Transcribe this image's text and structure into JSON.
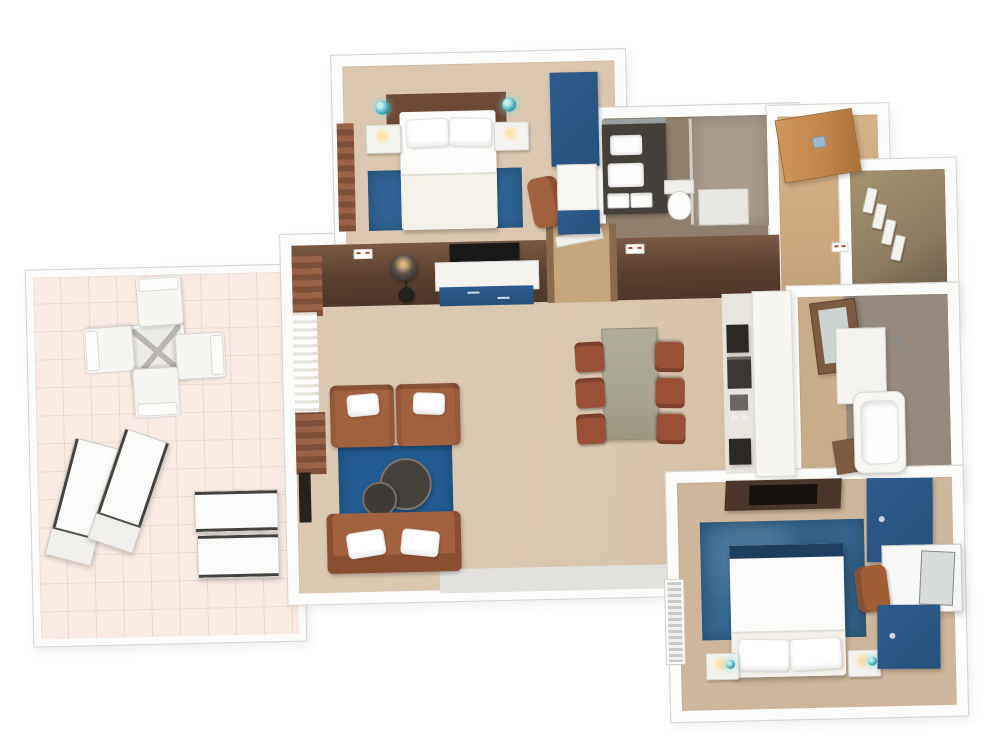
{
  "meta": {
    "title": "3D floor plan — two-bedroom suite with balcony terrace",
    "style": "top-down 3D architectural render on white background",
    "background": "#ffffff"
  },
  "colors": {
    "wall": "#fcfcfb",
    "wallEdge": "#d8d6d2",
    "shadowBand": "#e3e1de",
    "floorWood": "#d9c6ae",
    "floorBedroom1": "#dbc7af",
    "floorBedroom2": "#cdb69b",
    "floorBalcony": "#f9ebe2",
    "floorBath1": "#8f7f6c",
    "floorShower": "#a89b8a",
    "floorCorridor": "#cda97d",
    "floorCloset": "#8d7b61",
    "bath2Wood": "#c9ad8a",
    "bath2Tile": "#958a7d",
    "accentWallTop": "#7a5844",
    "accentWallBottom": "#4e372a",
    "headboard": "#6e4a36",
    "leather": "#a2613f",
    "leatherDark": "#8a4f33",
    "chairRust": "#9a5036",
    "rugBlue1": "#2e6292",
    "rugBlue2": "#235c92",
    "rugBlue3": "#35678f",
    "navy": "#27517d",
    "navyLight": "#2d5b8c",
    "footNavy": "#1d3e5f",
    "tableSage": "#a9a492",
    "charcoal": "#45413c",
    "tvBlack": "#191919",
    "teal": "#3fa9ba",
    "glow": "#ffdf9e",
    "doorWood": "#c08448",
    "woodDark": "#7c5b40",
    "dresserDark": "#4a372a",
    "mirror": "#ccd3d3"
  },
  "rooms": {
    "bedroom1": {
      "name": "Bedroom 1",
      "items": {
        "bed": "Double bed with white duvet",
        "headboard": "Brown headboard",
        "rug": "Blue area rug",
        "nightstandLeft": "Nightstand",
        "nightstandRight": "Nightstand",
        "pendantLeft": "Teal pendant light",
        "pendantRight": "Teal pendant light",
        "wardrobe": "Blue wardrobe unit",
        "chair": "Leather chair",
        "curtain": "Brown curtains"
      }
    },
    "bathroom1": {
      "name": "Bathroom 1",
      "items": {
        "vanity": "Dark double vanity with sinks and towels",
        "toilet": "Toilet",
        "shower": "Walk-in shower with glass panel"
      }
    },
    "entry": {
      "name": "Entry hall",
      "items": {
        "door": "Wooden entry door with keycard lock"
      }
    },
    "closet": {
      "name": "Walk-in closet",
      "items": {
        "hangers": "Hangers on rail"
      }
    },
    "living": {
      "name": "Living / dining room",
      "items": {
        "accentWall": "Dark brown accent wall",
        "tv": "Wall-mounted TV",
        "console": "Media console with blue drawers",
        "lamp": "Arc floor lamp",
        "armchairs": "Two leather armchairs",
        "sofa": "Leather sofa with white pillows",
        "rug": "Blue area rug",
        "coffeeTables": "Two round nesting coffee tables",
        "diningTable": "Dining table",
        "diningChairs": "Six leather dining chairs",
        "kitchenette": "Kitchenette counter with appliances",
        "curtains": "Curtains with white sheers",
        "doorway": "Doorway to hall",
        "sidePanel": "Dark wall panel"
      }
    },
    "bathroom2": {
      "name": "Bathroom 2",
      "items": {
        "tub": "Bathtub",
        "vanity": "Vanity with mirror",
        "cabinet": "Wood cabinet",
        "shower": "Shower fixture"
      }
    },
    "bedroom2": {
      "name": "Bedroom 2",
      "items": {
        "bed": "Double bed with white duvet",
        "footRunner": "Navy bed runner",
        "rug": "Large blue rug",
        "dresser": "Dark media dresser",
        "wardrobeTop": "Blue wardrobe",
        "wardrobeBottom": "Blue dresser",
        "desk": "Desk nook with mirror",
        "chair": "Leather desk chair",
        "nightstandLeft": "Nightstand with lamp",
        "nightstandRight": "Nightstand with lamp",
        "window": "Louvered window"
      }
    },
    "balcony": {
      "name": "Balcony terrace",
      "items": {
        "table": "Square glass-top table",
        "chairs": "Four outdoor chairs",
        "loungersAngled": "Two angled sun loungers",
        "loungersSide": "Two sun loungers"
      }
    }
  }
}
